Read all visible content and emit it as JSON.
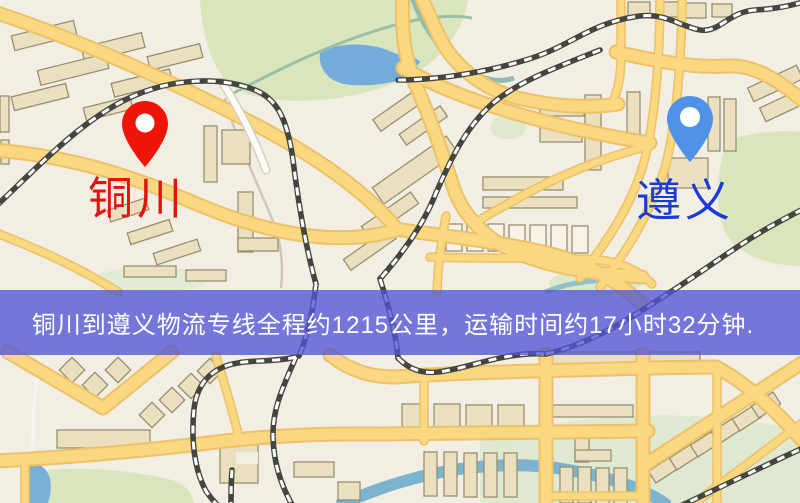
{
  "banner": {
    "text": "铜川到遵义物流专线全程约1215公里，运输时间约17小时32分钟.",
    "background": "#5254d6",
    "text_color": "#ffffff"
  },
  "map": {
    "markers": {
      "origin": {
        "name": "铜川",
        "pin_color": "#ee1508",
        "label_color": "#e0140a"
      },
      "destination": {
        "name": "遵义",
        "pin_color": "#4e92e9",
        "label_color": "#1c3ad6"
      }
    },
    "palette": {
      "background": "#f2eee3",
      "road_fill": "#f9d87f",
      "road_casing": "#ecc169",
      "building_fill": "#eae0c0",
      "building_stroke": "#97906f",
      "park": "#d9e6bb",
      "water": "#74addc",
      "railway": "#45453f"
    }
  }
}
